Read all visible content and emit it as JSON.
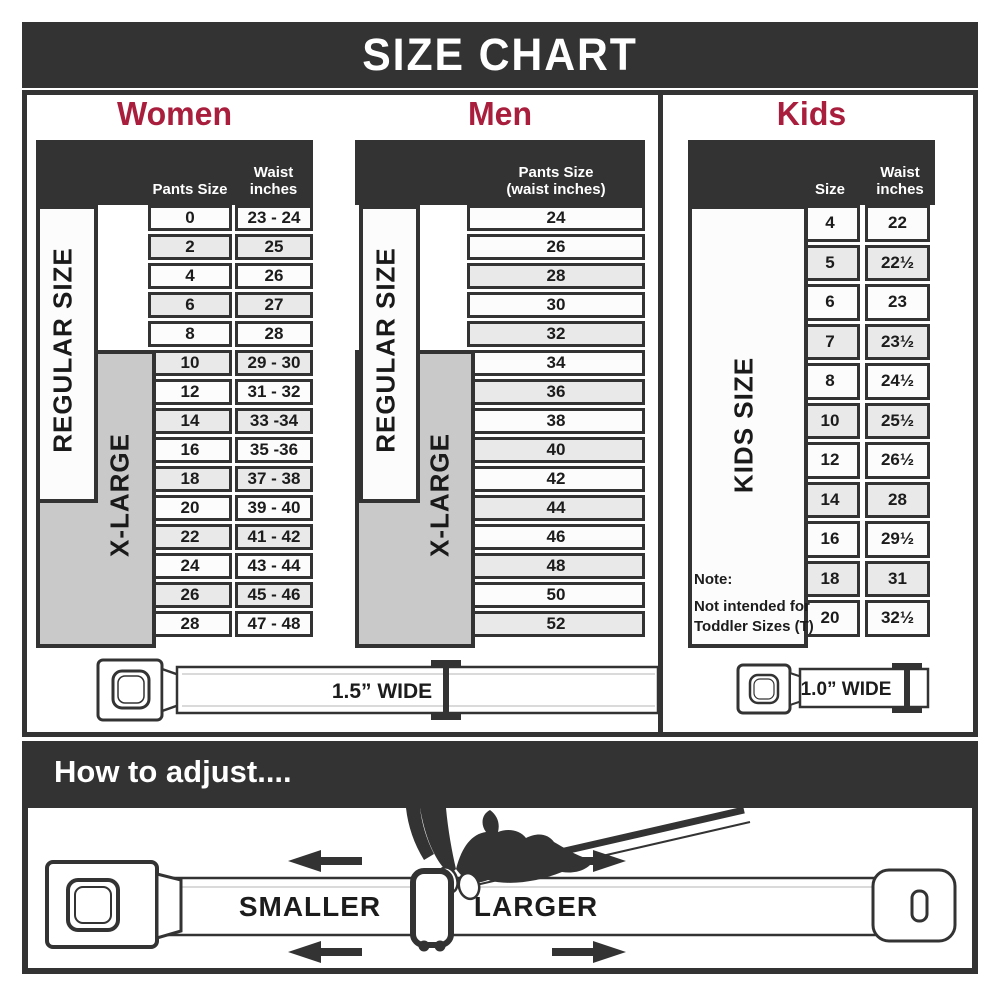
{
  "title": "SIZE CHART",
  "colors": {
    "accent": "#A91E3C",
    "dark": "#333333"
  },
  "women": {
    "heading": "Women",
    "col1_header": "Pants Size",
    "col2_header": "Waist inches",
    "regular_label": "REGULAR SIZE",
    "xlarge_label": "X-LARGE",
    "rows": [
      {
        "size": "0",
        "waist": "23 - 24"
      },
      {
        "size": "2",
        "waist": "25"
      },
      {
        "size": "4",
        "waist": "26"
      },
      {
        "size": "6",
        "waist": "27"
      },
      {
        "size": "8",
        "waist": "28"
      },
      {
        "size": "10",
        "waist": "29 - 30"
      },
      {
        "size": "12",
        "waist": "31 - 32"
      },
      {
        "size": "14",
        "waist": "33 -34"
      },
      {
        "size": "16",
        "waist": "35 -36"
      },
      {
        "size": "18",
        "waist": "37 - 38"
      },
      {
        "size": "20",
        "waist": "39 - 40"
      },
      {
        "size": "22",
        "waist": "41 - 42"
      },
      {
        "size": "24",
        "waist": "43 - 44"
      },
      {
        "size": "26",
        "waist": "45 - 46"
      },
      {
        "size": "28",
        "waist": "47 - 48"
      }
    ]
  },
  "men": {
    "heading": "Men",
    "col_header_line1": "Pants Size",
    "col_header_line2": "(waist inches)",
    "regular_label": "REGULAR SIZE",
    "xlarge_label": "X-LARGE",
    "rows": [
      "24",
      "26",
      "28",
      "30",
      "32",
      "34",
      "36",
      "38",
      "40",
      "42",
      "44",
      "46",
      "48",
      "50",
      "52"
    ]
  },
  "kids": {
    "heading": "Kids",
    "col1_header": "Size",
    "col2_header": "Waist inches",
    "side_label": "KIDS SIZE",
    "note_title": "Note:",
    "note_line1": "Not intended for",
    "note_line2": "Toddler Sizes (T)",
    "rows": [
      {
        "size": "4",
        "waist": "22"
      },
      {
        "size": "5",
        "waist": "22½"
      },
      {
        "size": "6",
        "waist": "23"
      },
      {
        "size": "7",
        "waist": "23½"
      },
      {
        "size": "8",
        "waist": "24½"
      },
      {
        "size": "10",
        "waist": "25½"
      },
      {
        "size": "12",
        "waist": "26½"
      },
      {
        "size": "14",
        "waist": "28"
      },
      {
        "size": "16",
        "waist": "29½"
      },
      {
        "size": "18",
        "waist": "31"
      },
      {
        "size": "20",
        "waist": "32½"
      }
    ]
  },
  "belts": {
    "adult_width_label": "1.5” WIDE",
    "kids_width_label": "1.0” WIDE"
  },
  "adjust": {
    "heading": "How to adjust....",
    "smaller_label": "SMALLER",
    "larger_label": "LARGER"
  }
}
